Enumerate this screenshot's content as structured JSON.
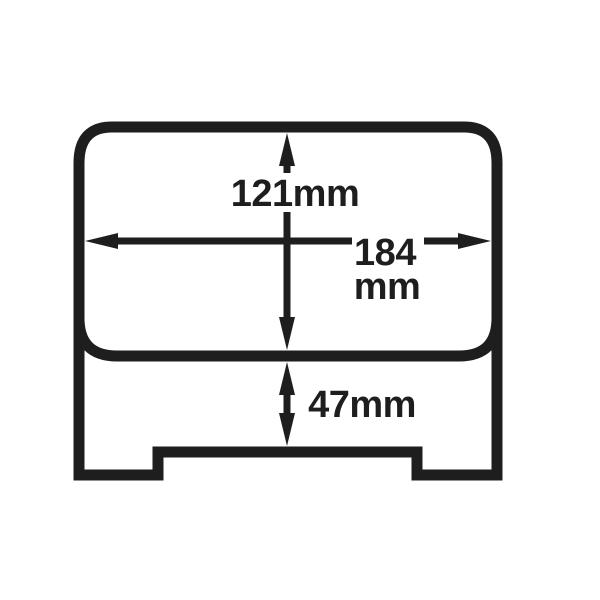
{
  "diagram": {
    "background": "#ffffff",
    "ink": "#1e1e1e",
    "dimensions": {
      "body_height": {
        "label": "121mm"
      },
      "overall_width": {
        "label": "184",
        "unit": "mm"
      },
      "base_height": {
        "label": "47mm"
      }
    }
  }
}
